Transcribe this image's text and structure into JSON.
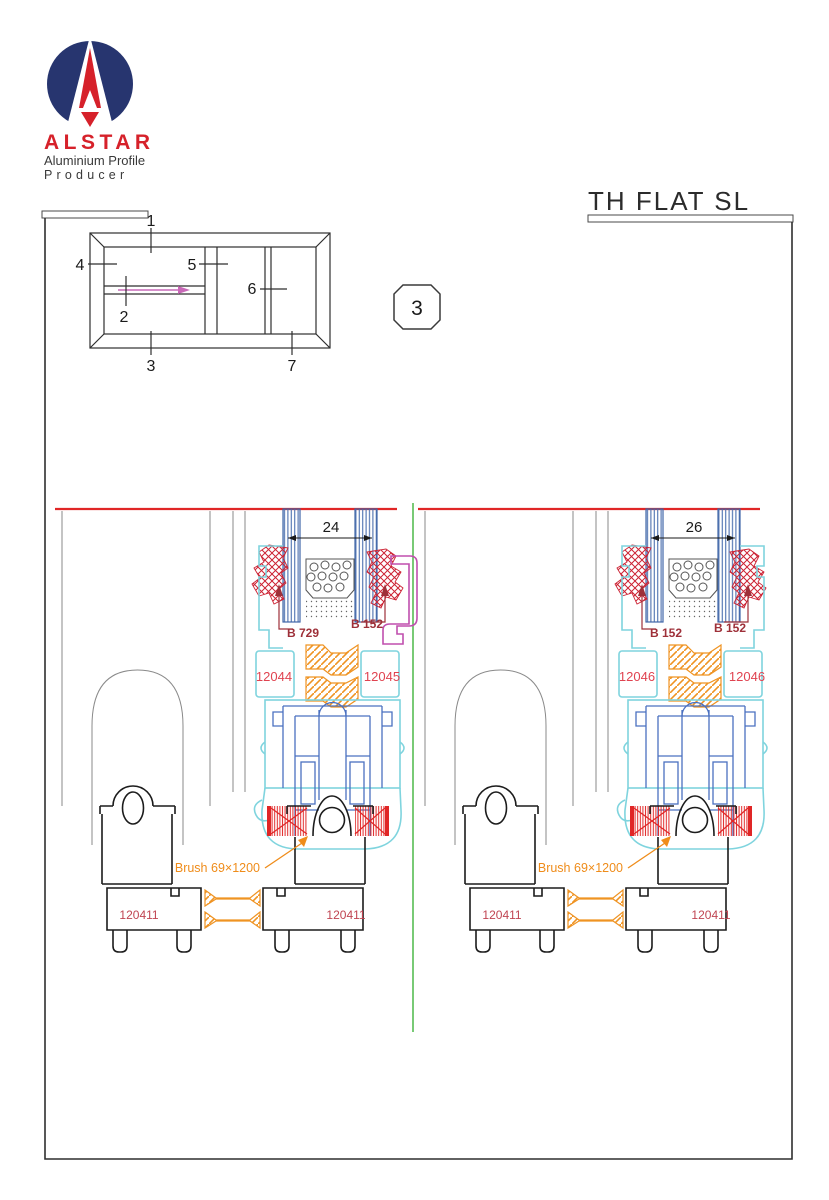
{
  "page": {
    "background": "#ffffff",
    "border_color": "#2f2f2f"
  },
  "brand": {
    "name": "ALSTAR",
    "tagline1": "Aluminium Profile",
    "tagline2": "Producer",
    "logo_navy": "#27356f",
    "logo_red": "#d6212a"
  },
  "title": "TH FLAT SL",
  "section_badge": "3",
  "schematic": {
    "labels": [
      "1",
      "2",
      "3",
      "4",
      "5",
      "6",
      "7"
    ]
  },
  "colors": {
    "red_line": "#e02626",
    "gasket_red": "#cc2233",
    "dark_red_label": "#9e3039",
    "profile_label_red": "#e04350",
    "track_label_red": "#c04552",
    "cyan_profile": "#7fd4de",
    "blue_hardware": "#4a70c0",
    "glass_blue": "#3f66a8",
    "orange": "#ef9322",
    "magenta": "#c04fae",
    "green_divider": "#4db848",
    "gray_panel": "#8a8a8a"
  },
  "details": [
    {
      "glass_width": "24",
      "gasket_left": "B 729",
      "gasket_right": "B 152",
      "profile_left": "12044",
      "profile_right": "12045",
      "brush_label": "Brush 69×1200",
      "track_left": "120411",
      "track_right": "120411"
    },
    {
      "glass_width": "26",
      "gasket_left": "B 152",
      "gasket_right": "B 152",
      "profile_left": "12046",
      "profile_right": "12046",
      "brush_label": "Brush 69×1200",
      "track_left": "120411",
      "track_right": "120411"
    }
  ]
}
